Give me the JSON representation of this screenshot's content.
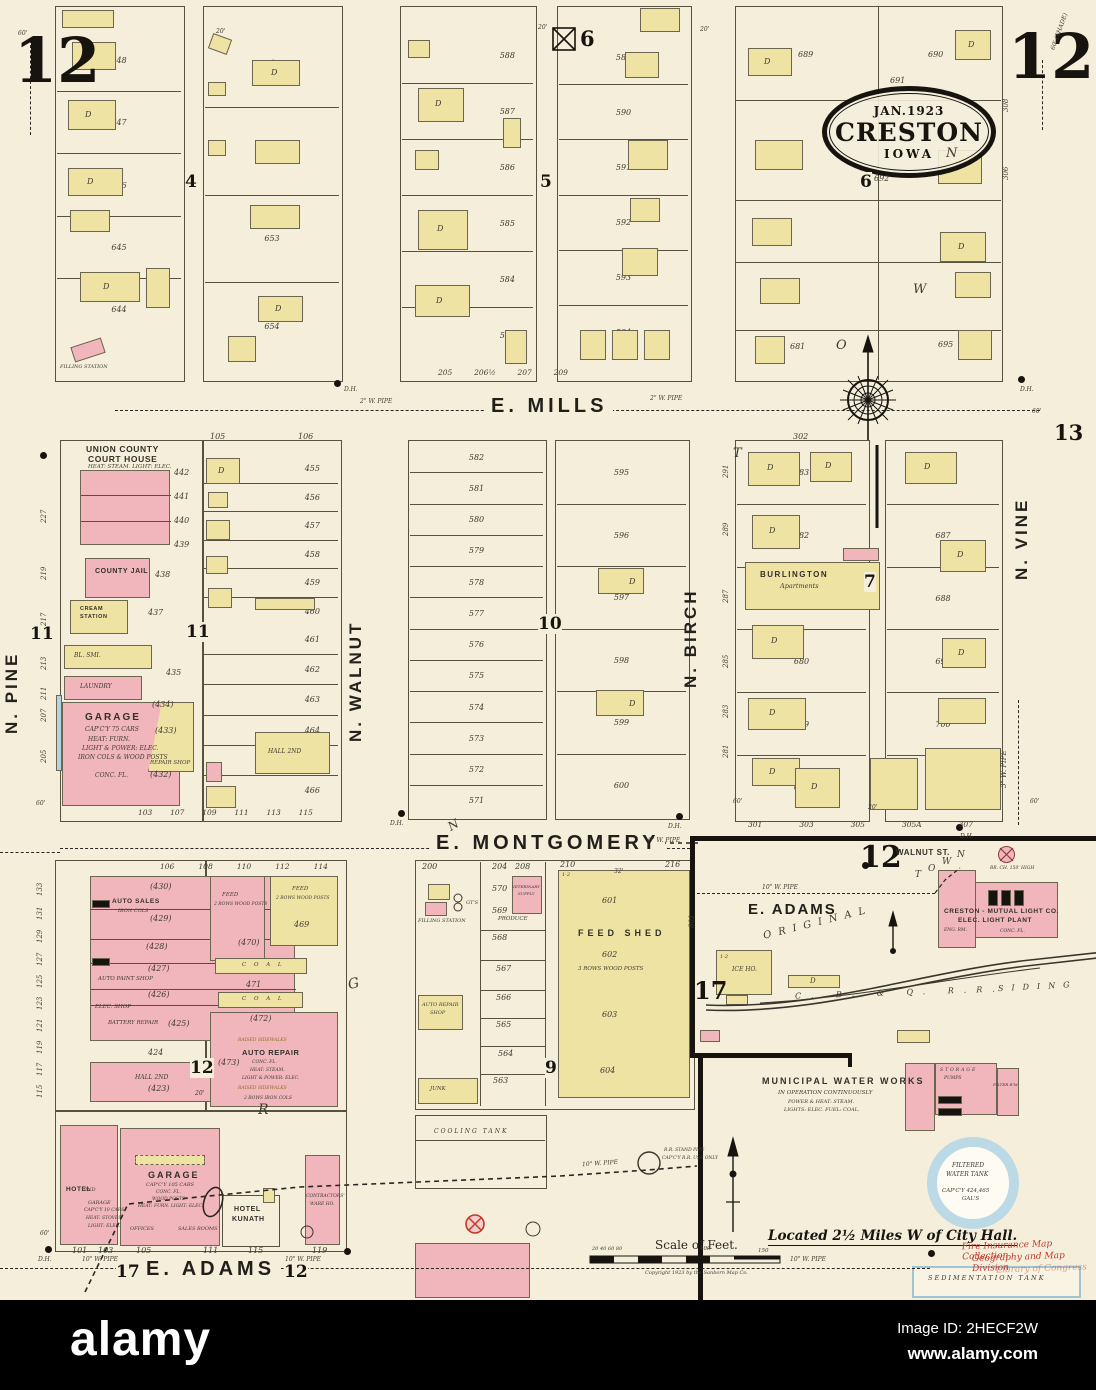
{
  "page": {
    "tl": "12",
    "tr": "12",
    "p13": "13"
  },
  "stamp": {
    "date": "JAN.1923",
    "city": "CRESTON",
    "state": "IOWA"
  },
  "streets": {
    "e_mills": "E. MILLS",
    "e_montgomery": "E. MONTGOMERY",
    "e_adams": "E. ADAMS",
    "walnut_st": "WALNUT ST.",
    "n_pine": "N. PINE",
    "n_walnut": "N. WALNUT",
    "n_birch": "N. BIRCH",
    "n_vine": "N. VINE"
  },
  "pipes": {
    "w2": "2\" W. PIPE",
    "w6": "6\" W. PIPE",
    "w10": "10\" W. PIPE",
    "w3": "3\" W. PIPE"
  },
  "widths": {
    "w20": "20'",
    "w60": "60'",
    "shade": "60' (SHADE)"
  },
  "letters": {
    "town": [
      "T",
      "O",
      "W",
      "N"
    ],
    "g": "G",
    "r": "R",
    "n_slant": "N",
    "original": "O R I G I N A L"
  },
  "dh": "D.H.",
  "misc": {
    "d": "D",
    "a": "A"
  },
  "blocks": {
    "b4": {
      "num": "4",
      "lots_left": [
        "648",
        "647",
        "646",
        "645",
        "644"
      ],
      "lots_right": [
        "649",
        "652",
        "653",
        "654"
      ],
      "filling": "FILLING STATION"
    },
    "b5": {
      "num": "5",
      "lots_left": [
        "588",
        "587",
        "586",
        "585",
        "584",
        "583"
      ],
      "lots_right": [
        "589",
        "590",
        "591",
        "592",
        "593",
        "594"
      ],
      "bottom": [
        "205",
        "206½",
        "207",
        "209"
      ]
    },
    "b6": {
      "num": "6",
      "nums": [
        "689",
        "690",
        "691",
        "692",
        "695",
        "681"
      ],
      "edge": [
        "308",
        "306"
      ]
    },
    "b11": {
      "num": "11",
      "title1": "UNION COUNTY",
      "title2": "COURT HOUSE",
      "title3": "HEAT: STEAM. LIGHT: ELEC.",
      "ch_nums": [
        "442",
        "441",
        "440",
        "439"
      ],
      "jail": "COUNTY JAIL",
      "jail_num": "438",
      "cream1": "CREAM",
      "cream2": "STATION",
      "cream_num": "437",
      "blsmi": "BL. SMI.",
      "n435": "435",
      "laundry": "LAUNDRY",
      "garage": "GARAGE",
      "g1": "CAP'C'Y 75 CARS",
      "g2": "HEAT: FURN.",
      "g3": "LIGHT & POWER: ELEC.",
      "g4": "IRON COLS & WOOD POSTS",
      "g5": "CONC. FL.",
      "repair": "REPAIR SHOP",
      "gnums": [
        "(434)",
        "(433)",
        "(432)"
      ],
      "hall": "HALL 2ND",
      "top_lots": [
        "105",
        "106"
      ],
      "right_lots_a": [
        "455",
        "456",
        "457",
        "458",
        "459",
        "460"
      ],
      "right_lots_b": [
        "461",
        "462",
        "463",
        "464",
        "465",
        "466"
      ],
      "bottom_lots": [
        "103",
        "107",
        "109",
        "111",
        "113",
        "115"
      ],
      "edge": [
        "227",
        "219",
        "217",
        "213",
        "211",
        "207",
        "205"
      ]
    },
    "b10": {
      "num": "10",
      "left": [
        "582",
        "581",
        "580",
        "579",
        "578",
        "577",
        "576",
        "575",
        "574",
        "573",
        "572",
        "571"
      ],
      "right": [
        "595",
        "596",
        "597",
        "598",
        "599",
        "600"
      ]
    },
    "b7": {
      "num": "7",
      "burlington1": "BURLINGTON",
      "burlington2": "Apartments",
      "left": [
        "683",
        "682",
        "681",
        "680",
        "679",
        "678"
      ],
      "right": [
        "686",
        "687",
        "688",
        "699",
        "700",
        "701"
      ],
      "edge": [
        "291",
        "289",
        "287",
        "285",
        "283",
        "281"
      ],
      "top": "302",
      "bottom": [
        "301",
        "303",
        "305",
        "305A",
        "307"
      ]
    },
    "b12": {
      "num": "12",
      "top_lots": [
        "106",
        "108",
        "110",
        "112",
        "114"
      ],
      "edge": [
        "133",
        "131",
        "129",
        "127",
        "125",
        "123",
        "121",
        "119",
        "117",
        "115"
      ],
      "auto_sales": "AUTO SALES",
      "iron_cols": "IRON COLS",
      "n430": "(430)",
      "n429": "(429)",
      "n428": "(428)",
      "n427": "(427)",
      "n426": "(426)",
      "paint": "AUTO PAINT SHOP",
      "elec": "ELEC. SHOP",
      "battery": "BATTERY REPAIR",
      "n425": "(425)",
      "n424": "424",
      "hall": "HALL 2ND",
      "n423": "(423)",
      "feed1": "FEED",
      "feed1b": "2 ROWS WOOD POSTS",
      "n470": "(470)",
      "feed2": "FEED",
      "feed2b": "2 ROWS WOOD POSTS",
      "n469": "469",
      "coal": "C O A L",
      "n471": "471",
      "coal2": "C O A L",
      "n472": "(472)",
      "ar": "AUTO REPAIR",
      "ar1": "CONC. FL.",
      "ar2": "HEAT: STEAM.",
      "ar3": "LIGHT & POWER: ELEC.",
      "ar4": "RAISED SIDEWALKS",
      "n473": "(473)",
      "ar5": "2 ROWS IRON COLS",
      "hotel": "HOTEL",
      "hotel2": "2ND",
      "gar_sm": "GARAGE",
      "gar_sm1": "CAP'C'Y 10 CARS",
      "gar_sm2": "HEAT: STOVES",
      "gar_sm3": "LIGHT: ELEC.",
      "gar": "GARAGE",
      "gar1": "CAP'C'Y 105 CARS",
      "gar2": "CONC. FL.",
      "gar3": "WOOD POSTS",
      "gar4": "HEAT: FURN. LIGHT: ELEC.",
      "offices": "OFFICES",
      "sales": "SALES ROOMS",
      "kunath1": "HOTEL",
      "kunath2": "KUNATH",
      "contractors1": "CONTRACTORS'",
      "contractors2": "WARE HO.",
      "bottom_lots": [
        "101",
        "103",
        "105",
        "111",
        "115",
        "119"
      ]
    },
    "b9": {
      "num": "9",
      "top_lots": [
        "200",
        "204",
        "208",
        "210",
        "216"
      ],
      "col": [
        "570",
        "569",
        "568",
        "567",
        "566",
        "565",
        "564",
        "563"
      ],
      "produce": "PRODUCE",
      "filling": "FILLING STATION",
      "gts": "GT'S",
      "vet1": "VETERINARY",
      "vet2": "SUPPLY",
      "autorepair1": "AUTO REPAIR",
      "autorepair2": "SHOP",
      "junk": "JUNK",
      "feedshed1": "FEED SHED",
      "feedshed2": "3 ROWS WOOD POSTS",
      "feed_nums": [
        "601",
        "602",
        "603",
        "604"
      ],
      "n12": "1-2",
      "w32": "32'"
    },
    "b17": {
      "num": "17",
      "num12": "12",
      "ice": "ICE HO.",
      "ice_n": "1-2",
      "lot801": "801",
      "light1": "CRESTON - MUTUAL LIGHT CO.",
      "light2": "ELEC. LIGHT PLANT",
      "light3": "ENG. RM.",
      "light4": "CONC. FL.",
      "chimney": "BR. CH. 150' HIGH",
      "rr1": "C. B. & Q. R.R.",
      "rr2": "SIDING"
    }
  },
  "waterworks": {
    "t1": "MUNICIPAL WATER WORKS",
    "t2": "IN OPERATION CONTINUOUSLY",
    "t3": "POWER & HEAT: STEAM.",
    "t4": "LIGHTS: ELEC. FUEL: COAL.",
    "storage": "STORAGE",
    "pumps": "PUMPS",
    "filter": "FILTER R'M"
  },
  "tanks": {
    "cooling": "COOLING TANK",
    "sed": "SEDIMENTATION TANK",
    "sp1": "R.R. STAND PIPE",
    "sp2": "CAP'C'Y R.R. USE ONLY",
    "f1": "FILTERED",
    "f2": "WATER TANK",
    "f3": "CAP'C'Y 424,465",
    "f4": "GAL'S"
  },
  "notes": {
    "located": "Located 2½ Miles W of City Hall.",
    "scale": "Scale of Feet.",
    "ticks": "20  40  60  80",
    "t100": "100",
    "t150": "150",
    "copyright": "Copyright 1923 by the Sanborn Map Co.",
    "wm1": "Fire Insurance Map Collection",
    "wm2": "Geography and Map Division",
    "wm3": "Library of Congress"
  },
  "alamy": {
    "logo": "alamy",
    "id": "Image ID: 2HECF2W",
    "url": "www.alamy.com"
  },
  "colors": {
    "paper": "#f4eedb",
    "frame_yellow": "#efe3a4",
    "brick_pink": "#f1b6bc",
    "water_blue": "#b5d2df",
    "ink": "#2a2723",
    "wm_red": "#c0392b"
  }
}
